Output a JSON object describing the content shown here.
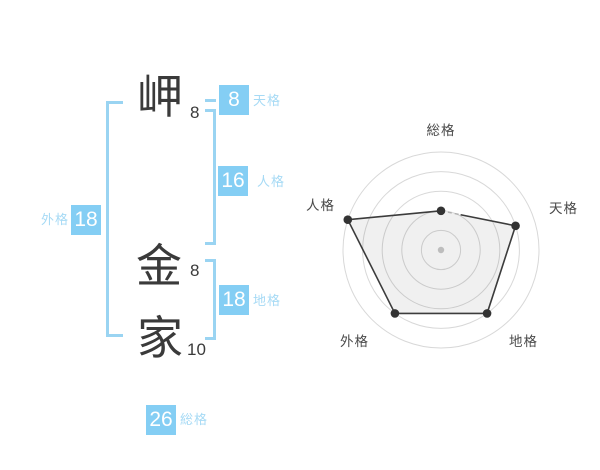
{
  "name_panel": {
    "characters": [
      {
        "char": "岬",
        "strokes": "8"
      },
      {
        "char": "金",
        "strokes": "8"
      },
      {
        "char": "家",
        "strokes": "10"
      }
    ],
    "badges": {
      "tenkaku": {
        "value": "8",
        "label": "天格"
      },
      "jinkaku": {
        "value": "16",
        "label": "人格"
      },
      "chikaku": {
        "value": "18",
        "label": "地格"
      },
      "gaikaku": {
        "value": "18",
        "label": "外格"
      },
      "soukaku": {
        "value": "26",
        "label": "総格"
      }
    }
  },
  "chart_data": {
    "type": "radar",
    "categories": [
      "総格",
      "天格",
      "地格",
      "外格",
      "人格"
    ],
    "values": [
      2,
      4,
      4,
      4,
      5
    ],
    "max": 5,
    "rings": 5,
    "start_axis": "総格",
    "direction": "clockwise",
    "grid": "concentric-circles",
    "legend": "none",
    "center": {
      "x": 441,
      "y": 250
    },
    "ring_step_px": 19.6,
    "partial_dashed_edge": {
      "from": "総格",
      "to": "天格",
      "length_px": 20
    }
  },
  "colors": {
    "badge_blue": "#84cef4",
    "bracket_blue": "#9ad4f2",
    "label_blue": "#a6daf5",
    "badge_text": "#ffffff",
    "kanji": "#3a3a3a",
    "grid_gray": "#d8d8d8",
    "polygon_line": "#3c3c3c",
    "polygon_fill": "rgba(0,0,0,0.06)",
    "dashed_stub": "#b0b0b0",
    "vertex_dot": "#333333",
    "center_dot": "#bdbdbd",
    "axis_label": "#4a4a4a",
    "background": "#ffffff"
  }
}
